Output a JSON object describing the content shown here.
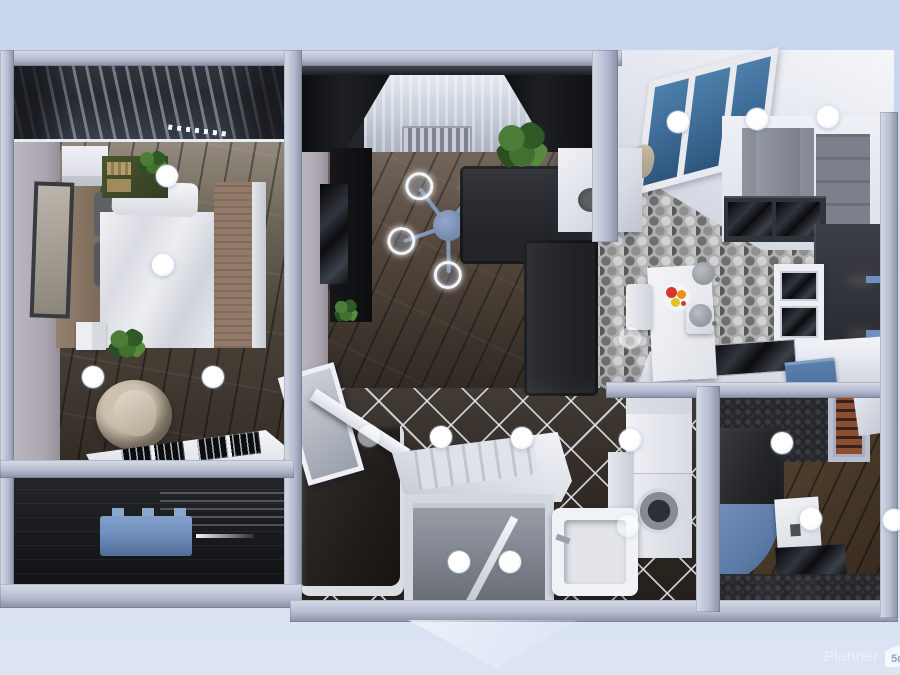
{
  "watermark": {
    "brand": "Planner",
    "logo": "5d"
  },
  "colors": {
    "background": "#c9d6ee",
    "background_bottom": "#dde5f4",
    "wall": "#b6bdd2",
    "wall_light": "#d7dce9",
    "wall_shadow": "#8a91a4",
    "skylight_glass": "#3f6e99",
    "hex_tile_base": "#b0b0b0",
    "diamond_tile": "#332c26",
    "sofa": "#27292d",
    "curtain": "#1a1c1f",
    "chandelier": "#8097ba",
    "bed_duvet": "#e6e8ec",
    "bed_blanket": "#917a69",
    "armchair": "#b6a997",
    "bench_blue": "#6f8fbd",
    "tray_blue": "#4a6f9e",
    "shower_curtain_blue": "#5c7ba8",
    "fruit_red": "#d63a2e",
    "fruit_orange": "#e8920f",
    "fruit_yellow": "#e2c324",
    "plant_green": "#3c6030",
    "hotspot": "#ffffff",
    "watermark_text": "#eef3fb"
  },
  "hotspots": [
    {
      "x": 167,
      "y": 176
    },
    {
      "x": 163,
      "y": 265
    },
    {
      "x": 93,
      "y": 377
    },
    {
      "x": 213,
      "y": 377
    },
    {
      "x": 678,
      "y": 122
    },
    {
      "x": 757,
      "y": 119
    },
    {
      "x": 828,
      "y": 117
    },
    {
      "x": 630,
      "y": 338,
      "dim": true
    },
    {
      "x": 369,
      "y": 436,
      "dim": true
    },
    {
      "x": 441,
      "y": 437
    },
    {
      "x": 522,
      "y": 438
    },
    {
      "x": 630,
      "y": 440
    },
    {
      "x": 782,
      "y": 443
    },
    {
      "x": 459,
      "y": 562
    },
    {
      "x": 510,
      "y": 562
    },
    {
      "x": 811,
      "y": 519
    },
    {
      "x": 894,
      "y": 520
    },
    {
      "x": 628,
      "y": 526,
      "dim": true
    }
  ]
}
